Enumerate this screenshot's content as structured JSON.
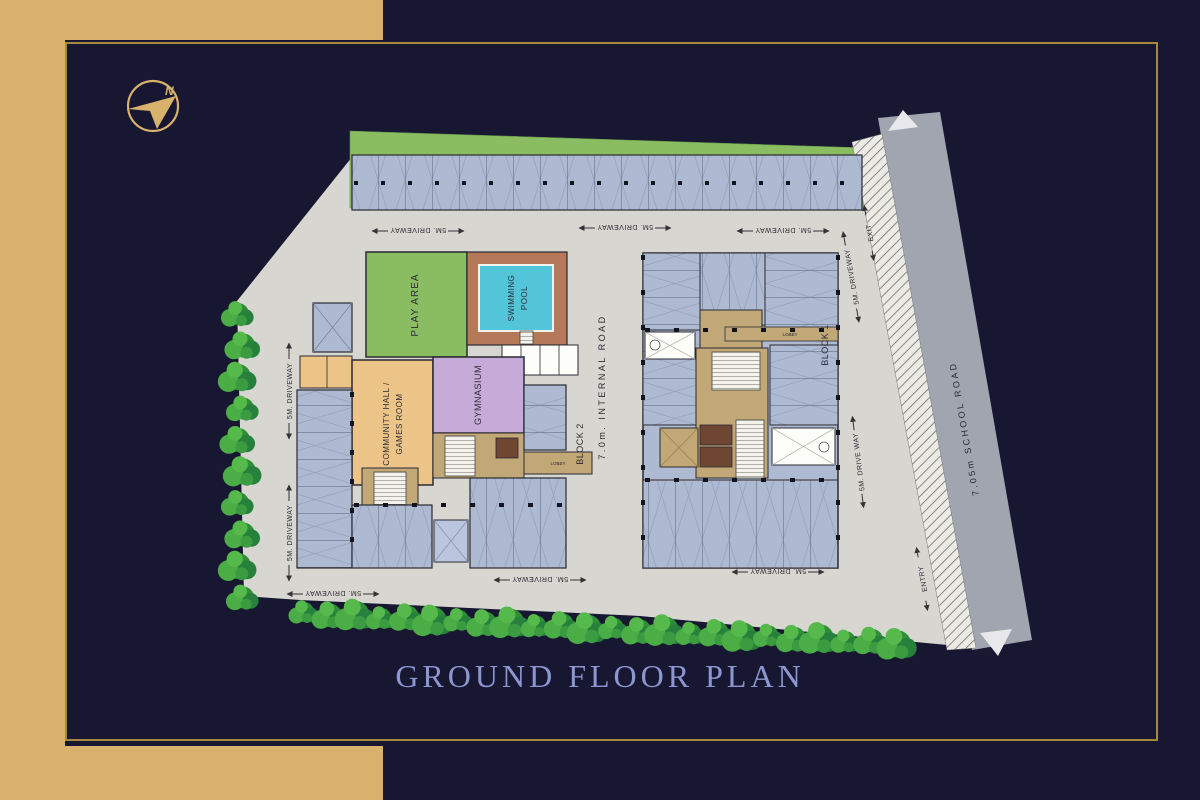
{
  "title": "GROUND FLOOR PLAN",
  "compass": {
    "north": "N"
  },
  "colors": {
    "background": "#171731",
    "gold_band": "#d8b26c",
    "frame_line": "#a8873e",
    "title_text": "#8c96d0",
    "site_ground": "#d7d6d1",
    "green_area": "#8abc62",
    "parking_stall": "#aeb9d2",
    "community_hall": "#ecc488",
    "gymnasium": "#c6abd8",
    "pool_water": "#52c6d8",
    "pool_deck": "#b5795a",
    "road": "#a0a5b0",
    "tree": "#3b9b41"
  },
  "plan": {
    "play_area": "PLAY AREA",
    "swimming_pool": [
      "SWIMMING",
      "POOL"
    ],
    "community_hall": [
      "COMMUNITY HALL /",
      "GAMES ROOM"
    ],
    "gymnasium": "GYMNASIUM",
    "block1": "BLOCK 1",
    "block2": "BLOCK 2",
    "internal_road": "7.0m. INTERNAL ROAD",
    "school_road": "7.05m SCHOOL ROAD",
    "driveway": "5M. DRIVEWAY",
    "driveway_split": "5M. DRIVE WAY",
    "exit": "EXIT",
    "entry": "ENTRY",
    "lobby": "LOBBY"
  }
}
